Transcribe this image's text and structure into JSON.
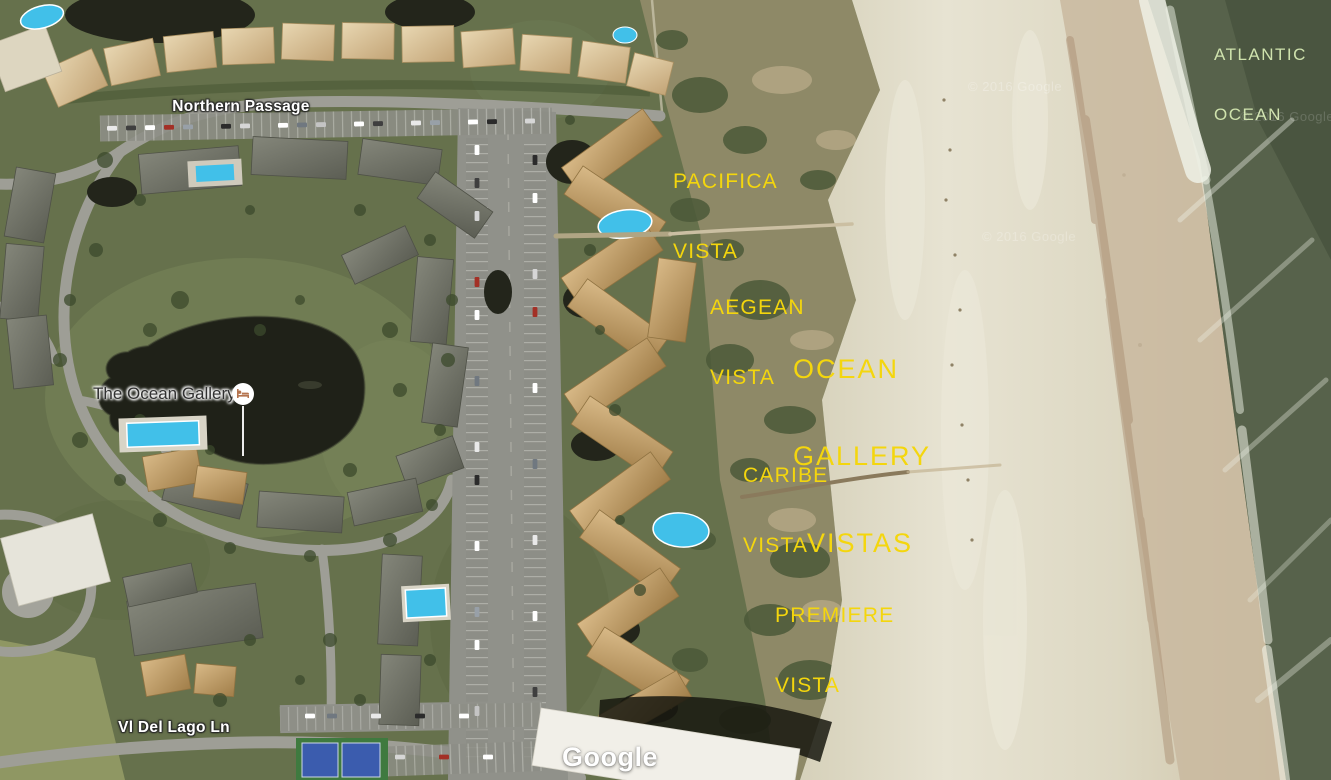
{
  "map": {
    "type": "satellite",
    "ocean_name": {
      "line1": "ATLANTIC",
      "line2": "OCEAN"
    },
    "area_labels": {
      "pacifica": {
        "line1": "PACIFICA",
        "line2": "VISTA"
      },
      "aegean": {
        "line1": "AEGEAN",
        "line2": "VISTA"
      },
      "ocean_gallery": {
        "line1": "OCEAN",
        "line2": "GALLERY",
        "line3": "VISTAS"
      },
      "caribe": {
        "line1": "CARIBE",
        "line2": "VISTA"
      },
      "premiere": {
        "line1": "PREMIERE",
        "line2": "VISTA"
      }
    },
    "roads": {
      "northern_passage": "Northern Passage",
      "vi_del_lago": "Vl Del Lago Ln"
    },
    "poi": {
      "name": "The Ocean Gallery",
      "icon": "lodging-icon"
    },
    "attribution": {
      "logo": "Google",
      "copyright": "© 2016 Google"
    },
    "colors": {
      "label_yellow": "#f4d60d",
      "ocean_label_green": "#cfe2ad",
      "sand": "#d9d4c0",
      "ocean": "#5a664e",
      "vegetation": "#66714c",
      "lake": "#1f2118",
      "pool_blue": "#41c0e9",
      "road_gray": "#9e9e96"
    }
  }
}
